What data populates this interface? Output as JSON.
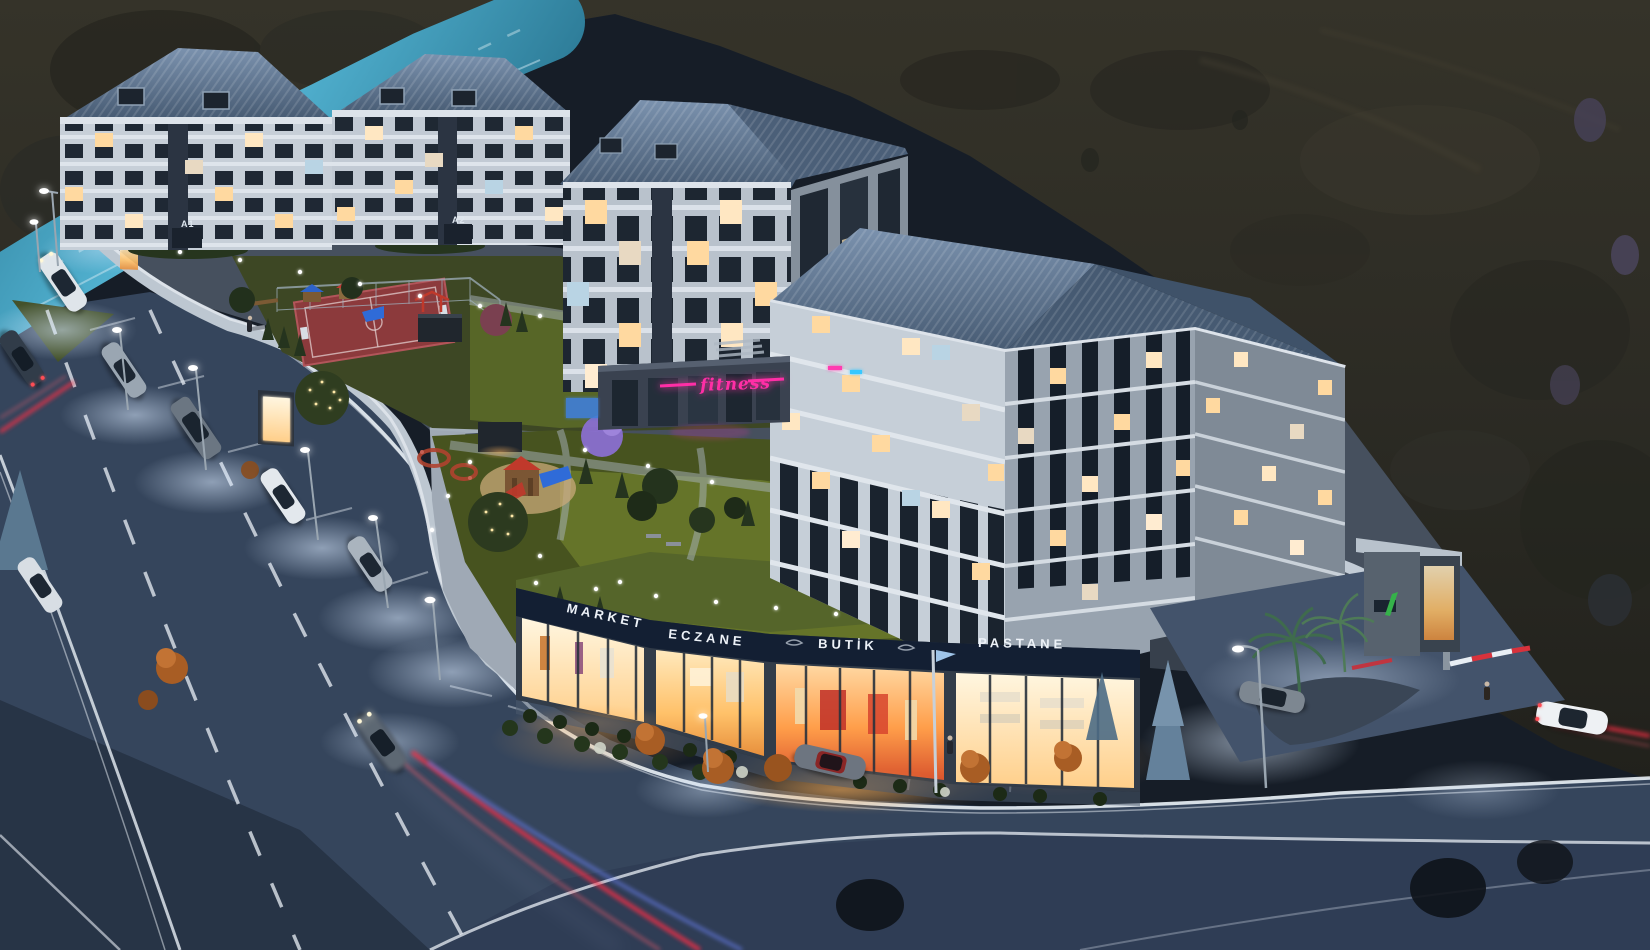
{
  "scene": {
    "description": "Night aerial 3D architectural rendering of a terraced residential complex with landscaped courtyards, ground-floor shops and surrounding roads",
    "buildings": {
      "a1_label": "A1",
      "a2_label": "A2"
    },
    "shops": {
      "market": "MARKET",
      "eczane": "ECZANE",
      "butik": "BUTİK",
      "pastane": "PASTANE"
    },
    "neon_sign": "fitness",
    "colors": {
      "neon_pink": "#ff2fa6",
      "sign_fascia": "#131f33",
      "sign_text": "#edf2f8",
      "warm_window": "#ffd9a0",
      "cool_window": "#b9d4e4",
      "roof_blue": "#56708e",
      "lawn_green": "#5a6a26",
      "upper_road_cyan": "#41a3c4",
      "road_asphalt": "#394a60",
      "curb_white": "#e9eff5",
      "trail_red": "#ff2e44",
      "trail_blue": "#6f86ff",
      "barrier_red": "#d8323c",
      "logo_green": "#35b24a",
      "palm_green": "#3f6b4d",
      "autumn_orange": "#a85d24",
      "blossom_pink": "#d2699e"
    }
  }
}
